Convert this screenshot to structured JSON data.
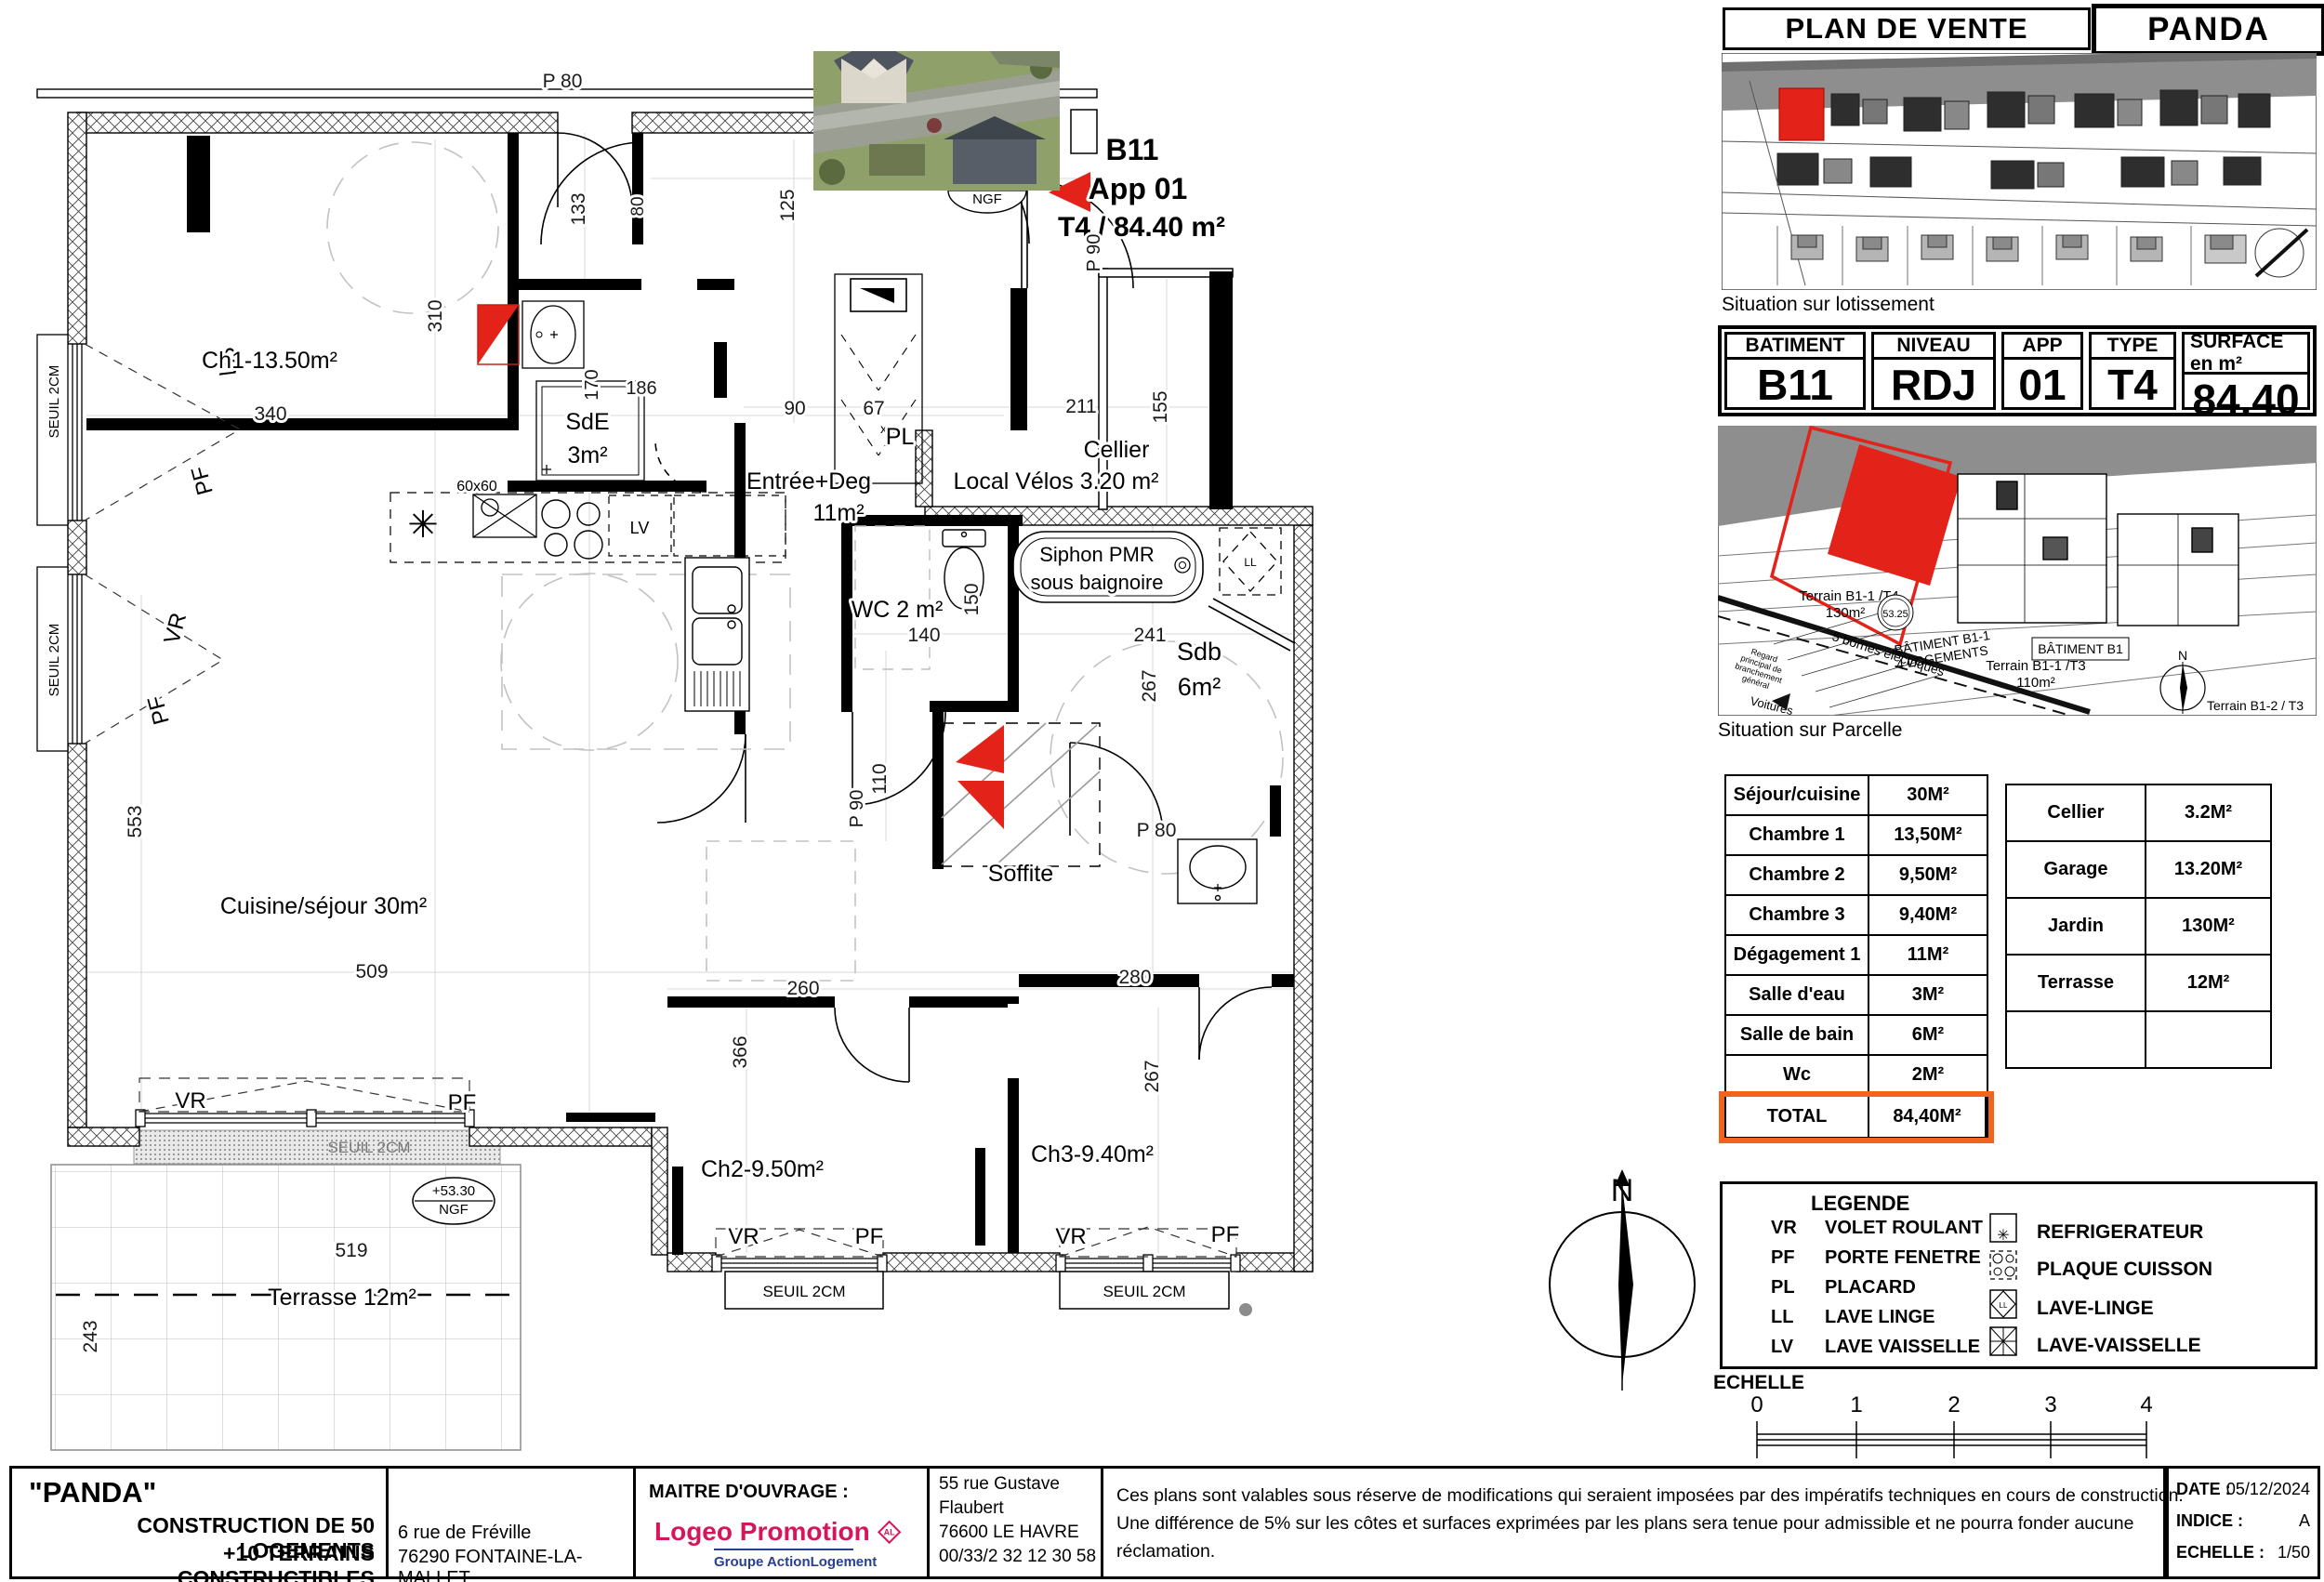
{
  "colors": {
    "red": "#e3231a",
    "orange": "#f2641c",
    "logeo_pink": "#d6165b",
    "logeo_blue": "#28408f",
    "grey_band": "#8e8e8e"
  },
  "header": {
    "title": "PLAN DE VENTE",
    "brand": "PANDA"
  },
  "captions": {
    "lotissement": "Situation sur lotissement",
    "parcelle": "Situation sur Parcelle"
  },
  "batiment": {
    "headers": [
      "BATIMENT",
      "NIVEAU",
      "APP",
      "TYPE",
      "SURFACE en m²"
    ],
    "values": [
      "B11",
      "RDJ",
      "01",
      "T4",
      "84.40"
    ]
  },
  "parcelle": {
    "terrain1a": "Terrain B1-1 /T4",
    "terrain1b": "130m²",
    "cote": "53.25",
    "bat1a": "BÂTIMENT  B1-1",
    "bat1b": "4 LOGEMENTS",
    "terrain2a": "Terrain B1-1 /T3",
    "terrain2b": "110m²",
    "bat2": "BÂTIMENT B1",
    "bornes": "5 bornes électriques",
    "regard1": "Regard",
    "regard2": "principal de",
    "regard3": "branchement",
    "regard4": "général",
    "voitures": "Voitures",
    "terrain3": "Terrain B1-2 / T3",
    "north": "N"
  },
  "surfaces": {
    "rows": [
      {
        "label": "Séjour/cuisine",
        "value": "30M²"
      },
      {
        "label": "Chambre 1",
        "value": "13,50M²"
      },
      {
        "label": "Chambre 2",
        "value": "9,50M²"
      },
      {
        "label": "Chambre 3",
        "value": "9,40M²"
      },
      {
        "label": "Dégagement 1",
        "value": "11M²"
      },
      {
        "label": "Salle d'eau",
        "value": "3M²"
      },
      {
        "label": "Salle de bain",
        "value": "6M²"
      },
      {
        "label": "Wc",
        "value": "2M²"
      },
      {
        "label": "TOTAL",
        "value": "84,40M²"
      }
    ]
  },
  "annex": {
    "rows": [
      {
        "label": "Cellier",
        "value": "3.2M²"
      },
      {
        "label": "Garage",
        "value": "13.20M²"
      },
      {
        "label": "Jardin",
        "value": "130M²"
      },
      {
        "label": "Terrasse",
        "value": "12M²"
      },
      {
        "label": "",
        "value": ""
      }
    ]
  },
  "legend": {
    "title": "LEGENDE",
    "abbr": [
      {
        "code": "VR",
        "label": "VOLET ROULANT"
      },
      {
        "code": "PF",
        "label": "PORTE FENETRE"
      },
      {
        "code": "PL",
        "label": "PLACARD"
      },
      {
        "code": "LL",
        "label": "LAVE LINGE"
      },
      {
        "code": "LV",
        "label": "LAVE VAISSELLE"
      }
    ],
    "icons": [
      {
        "name": "REFRIGERATEUR"
      },
      {
        "name": "PLAQUE CUISSON"
      },
      {
        "name": "LAVE-LINGE"
      },
      {
        "name": "LAVE-VAISSELLE"
      }
    ],
    "ll_glyph": "LL",
    "star": "✳"
  },
  "echelle": {
    "label": "ECHELLE",
    "ticks": [
      "0",
      "1",
      "2",
      "3",
      "4"
    ]
  },
  "footer": {
    "project": {
      "name": "\"PANDA\"",
      "line2": "CONSTRUCTION DE 50 LOGEMENTS",
      "line3": "+10 TERRAINS CONSTRUCTIBLES"
    },
    "address1": {
      "l1": "6 rue de Fréville",
      "l2": "76290 FONTAINE-LA-MALLET"
    },
    "mo": {
      "label": "MAITRE D'OUVRAGE :",
      "brand": "Logeo Promotion",
      "badge": "AL",
      "sub": "Groupe ActionLogement"
    },
    "address2": {
      "l1": "55 rue Gustave",
      "l2": "Flaubert",
      "l3": "76600 LE HAVRE",
      "l4": "00/33/2 32 12 30 58"
    },
    "disclaimer": {
      "l1": "Ces plans sont valables sous réserve de modifications qui seraient imposées par des impératifs techniques en cours de construction.",
      "l2": "Une différence de 5% sur les côtes et surfaces exprimées par les plans sera tenue pour admissible et ne pourra fonder aucune",
      "l3": "réclamation."
    },
    "meta": {
      "date_label": "DATE :",
      "date": "05/12/2024",
      "indice_label": "INDICE :",
      "indice": "A",
      "echelle_label": "ECHELLE :",
      "echelle": "1/50"
    }
  },
  "plan": {
    "apt": {
      "b11": "B11",
      "app": "App 01",
      "type": "T4 / 84.40 m²"
    },
    "ngf": {
      "a": "+53.30",
      "b": "NGF"
    },
    "rooms": {
      "ch1": "Ch1-13.50m²",
      "sde1": "SdE",
      "sde2": "3m²",
      "ent1": "Entrée+Deg",
      "ent2": "11m²",
      "cel1": "Cellier",
      "cel2": "Local Vélos 3.20 m²",
      "wc": "WC 2 m²",
      "bain1": "Siphon PMR",
      "bain2": "sous baignoire",
      "sdb1": "Sdb",
      "sdb2": "6m²",
      "sej": "Cuisine/séjour 30m²",
      "sof": "Soffite",
      "ch2": "Ch2-9.50m²",
      "ch3": "Ch3-9.40m²",
      "ter": "Terrasse 12m²"
    },
    "dims": {
      "d340": "340",
      "d310": "310",
      "d133": "133",
      "d80": "80",
      "d254": "254",
      "d125": "125",
      "d90": "90",
      "d67": "67",
      "d211": "211",
      "d155": "155",
      "d170": "170",
      "d186": "186",
      "d140": "140",
      "d150": "150",
      "d241": "241",
      "d267": "267",
      "d110": "110",
      "d553": "553",
      "d509": "509",
      "d366": "366",
      "d260": "260",
      "d280": "280",
      "d267b": "267",
      "d519": "519",
      "d243": "243"
    },
    "doors": {
      "p80a": "P 80",
      "p80r": "80",
      "pp90": "PP 90",
      "p90a": "P 90",
      "p90b": "P 90",
      "p80b": "P 80"
    },
    "win": {
      "vr": "VR",
      "pf": "PF",
      "seuil": "SEUIL 2CM"
    },
    "kitchen": {
      "x60": "60x60",
      "lv": "LV",
      "ll": "LL",
      "pl": "PL"
    },
    "north": "N"
  }
}
